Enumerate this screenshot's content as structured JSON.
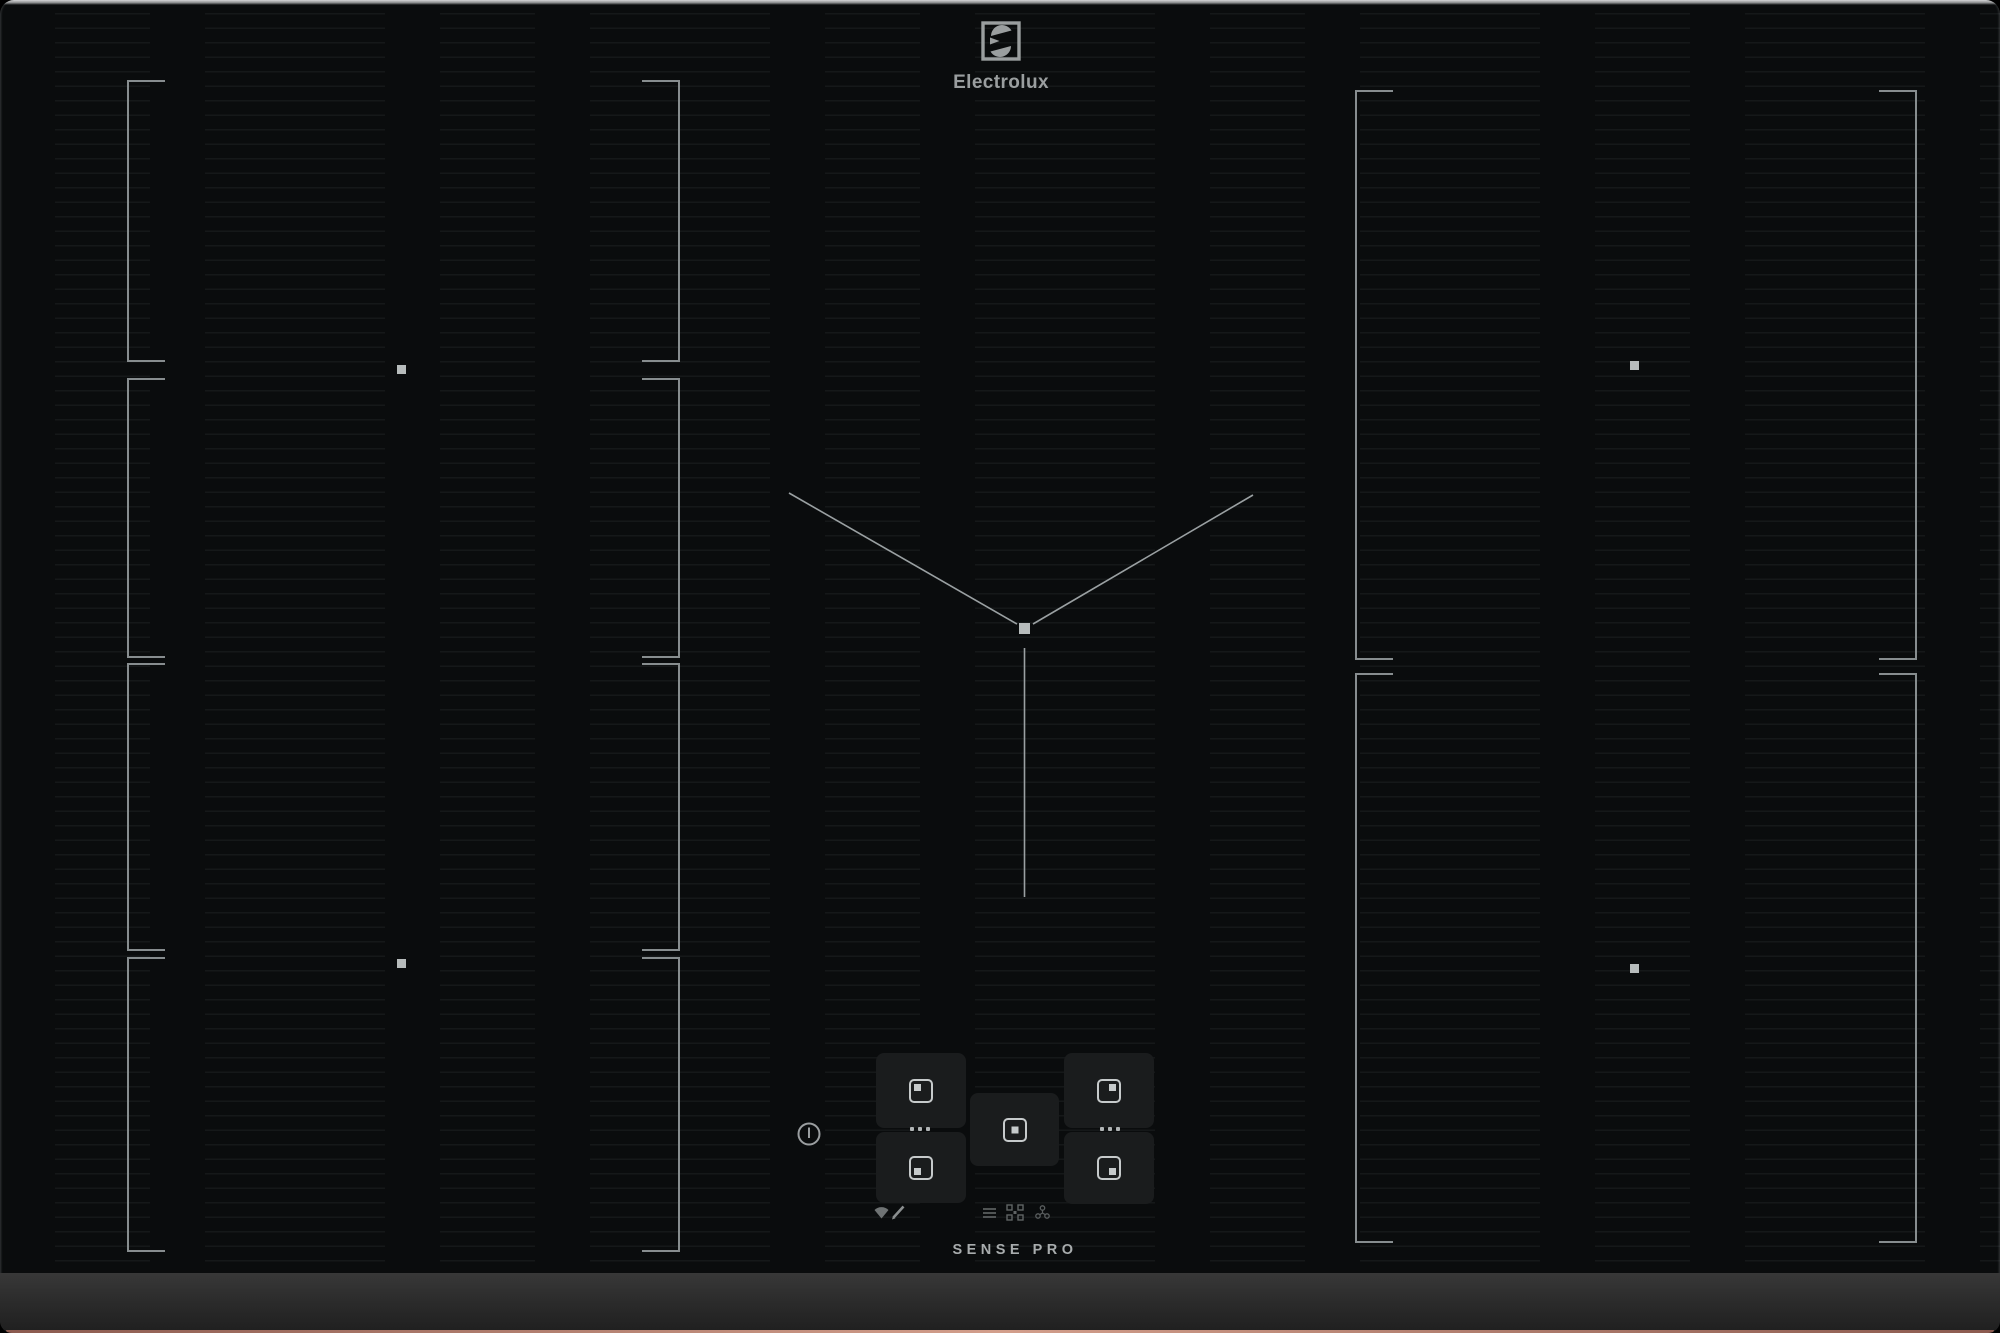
{
  "brand": {
    "logo_text": "Electrolux",
    "logo_icon": "electrolux-e-symbol",
    "color": "#9a9e9f"
  },
  "footer": {
    "label": "SENSE PRO"
  },
  "surface": {
    "glass_color": "#0a0c0d",
    "pinstripe_color": "rgba(222,234,240,0.055)",
    "bracket_color": "#878d8f",
    "marker_color": "#b7bcbc",
    "trim_color": "#2c2c2c",
    "copper_edge_color": "#b07a6c"
  },
  "zones": {
    "left_segment_count": 4,
    "right_zone_count": 2,
    "left_markers": 2,
    "right_markers": 2,
    "center": {
      "guide": "v-shaped alignment lines with center square marker"
    }
  },
  "control_panel": {
    "power_icon": "power-standby-icon",
    "pads": [
      {
        "id": "zone-pad-left-top",
        "indicator": "top-left"
      },
      {
        "id": "zone-pad-left-bottom",
        "indicator": "bottom-left"
      },
      {
        "id": "zone-pad-center",
        "indicator": "center"
      },
      {
        "id": "zone-pad-right-top",
        "indicator": "top-right"
      },
      {
        "id": "zone-pad-right-bottom",
        "indicator": "bottom-right"
      }
    ],
    "pad_dot_count": 3,
    "utility_icons": [
      "wifi-icon",
      "pencil-icon",
      "menu-icon",
      "bridge-icon",
      "hob2hood-fan-icon"
    ]
  }
}
